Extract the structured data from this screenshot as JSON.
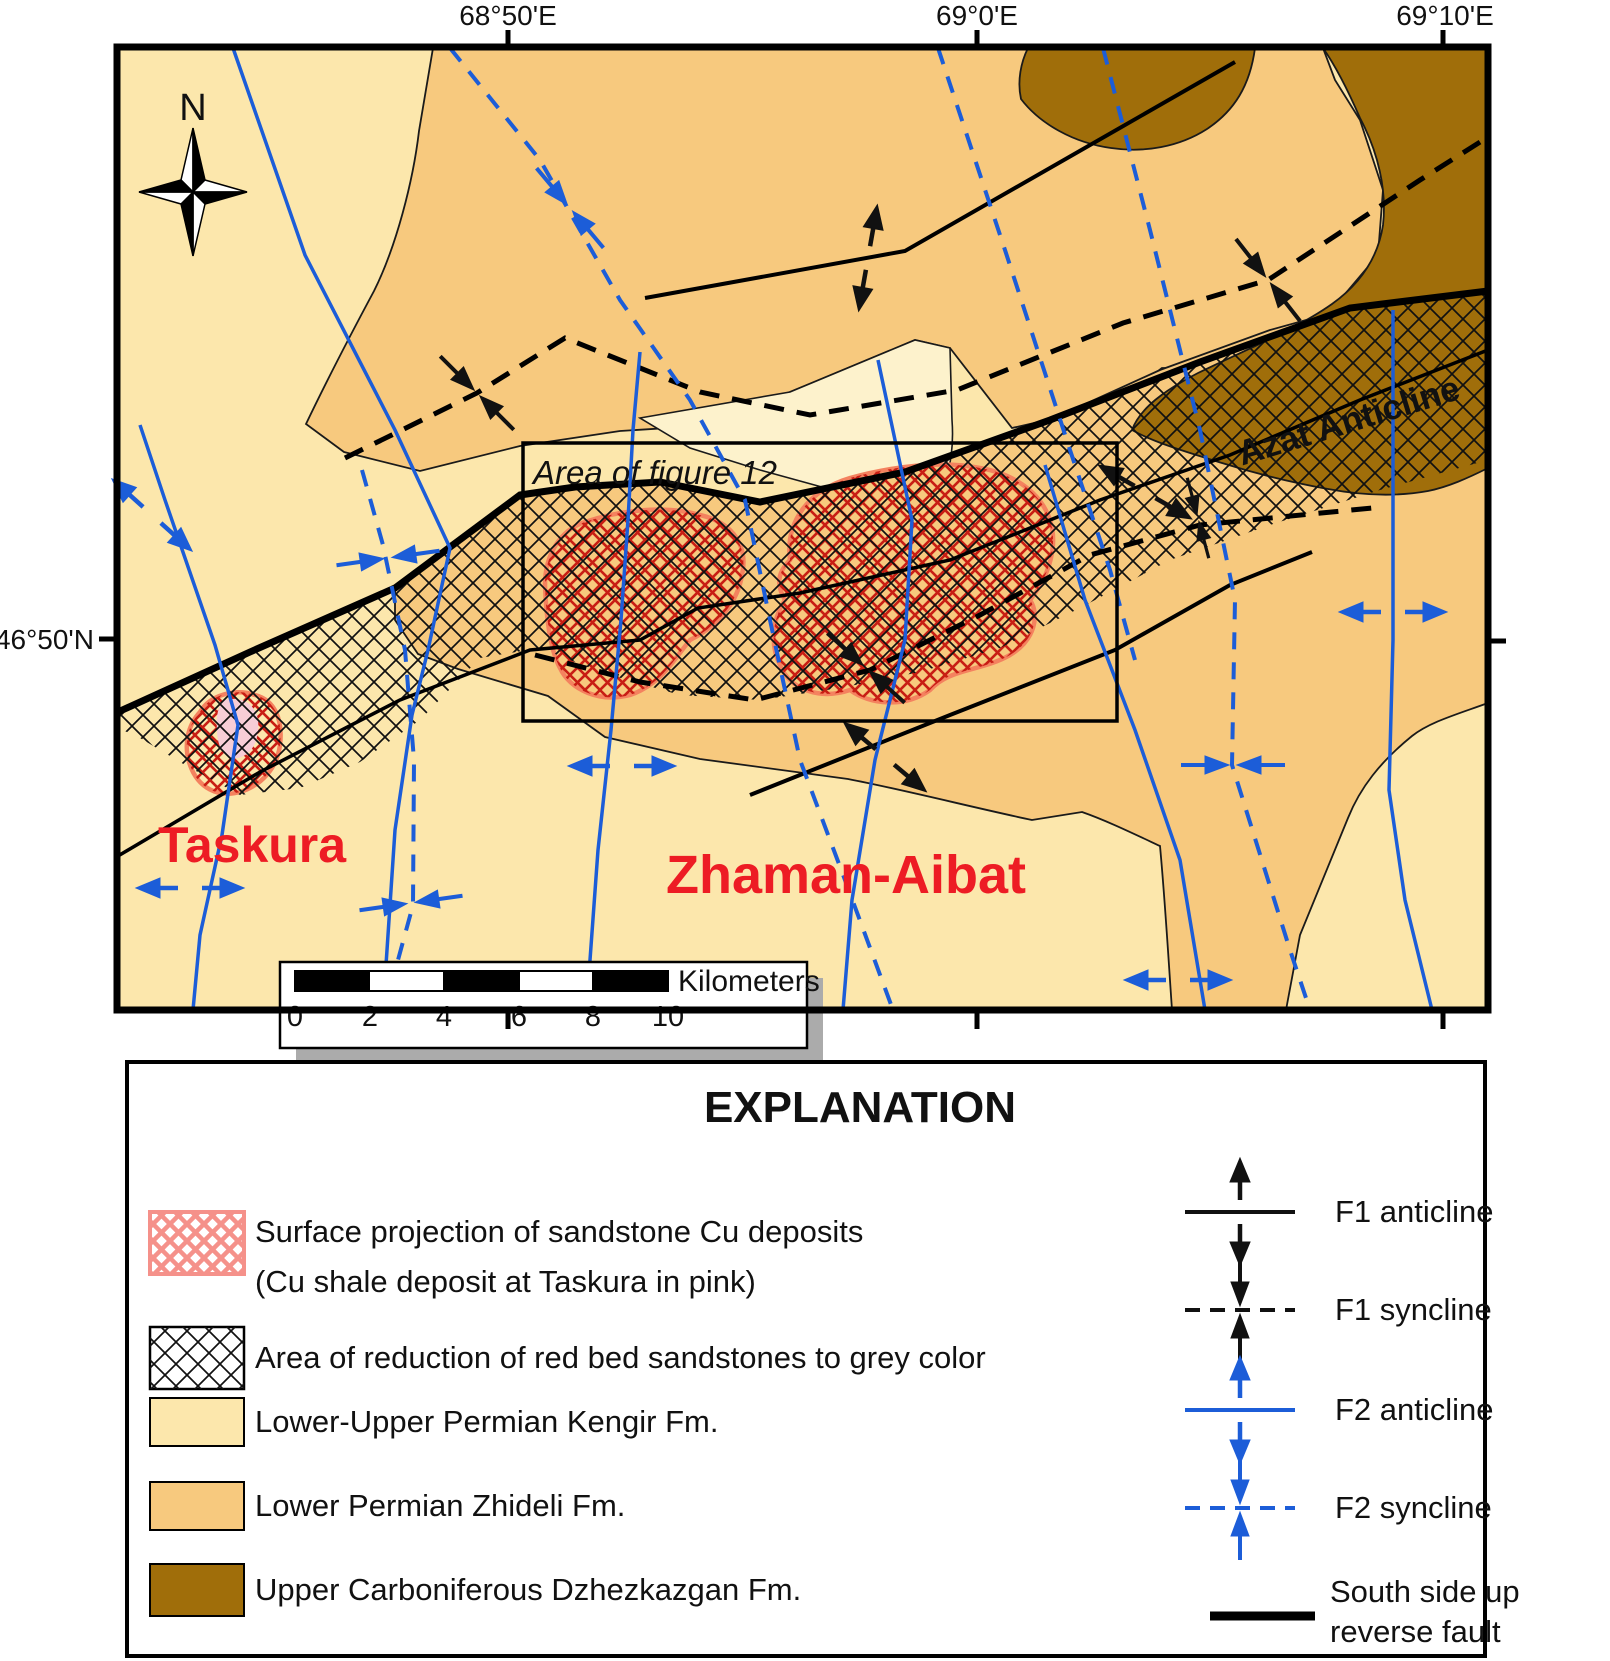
{
  "map": {
    "compass_label": "N",
    "coordinates": {
      "top": [
        "68°50'E",
        "69°0'E",
        "69°10'E"
      ],
      "left": "46°50'N"
    },
    "place_labels": {
      "taskura": "Taskura",
      "zhaman_aibat": "Zhaman-Aibat",
      "azat_anticline": "Azat Anticline",
      "figure_area": "Area of figure 12"
    },
    "scale_bar": {
      "tick_labels": [
        "0",
        "2",
        "4",
        "6",
        "8",
        "10"
      ],
      "unit_label": "Kilometers"
    }
  },
  "legend": {
    "title": "EXPLANATION",
    "items_left": [
      {
        "label_lines": [
          "Surface projection of sandstone Cu deposits",
          "(Cu shale deposit at Taskura in pink)"
        ]
      },
      {
        "label_lines": [
          "Area of reduction of red bed sandstones to grey color"
        ]
      },
      {
        "label_lines": [
          "Lower-Upper Permian  Kengir Fm."
        ]
      },
      {
        "label_lines": [
          "Lower Permian  Zhideli Fm."
        ]
      },
      {
        "label_lines": [
          "Upper Carboniferous  Dzhezkazgan Fm."
        ]
      }
    ],
    "items_right": [
      {
        "label": "F1 anticline"
      },
      {
        "label": "F1 syncline"
      },
      {
        "label": "F2 anticline"
      },
      {
        "label": "F2 syncline"
      },
      {
        "label_lines": [
          "South side up",
          "reverse fault"
        ]
      }
    ]
  },
  "colors": {
    "kengir": "#FCE7AC",
    "kengir_pale": "#FDF2CC",
    "zhideli": "#F7C97E",
    "dzhezkazgan": "#A06E0A",
    "deposit_hatch_red": "#C81E14",
    "deposit_outline_salmon": "#F4825F",
    "taskura_pink": "#F7CDD6",
    "fold_blue": "#1C5DD8",
    "label_red": "#ED1C24"
  }
}
